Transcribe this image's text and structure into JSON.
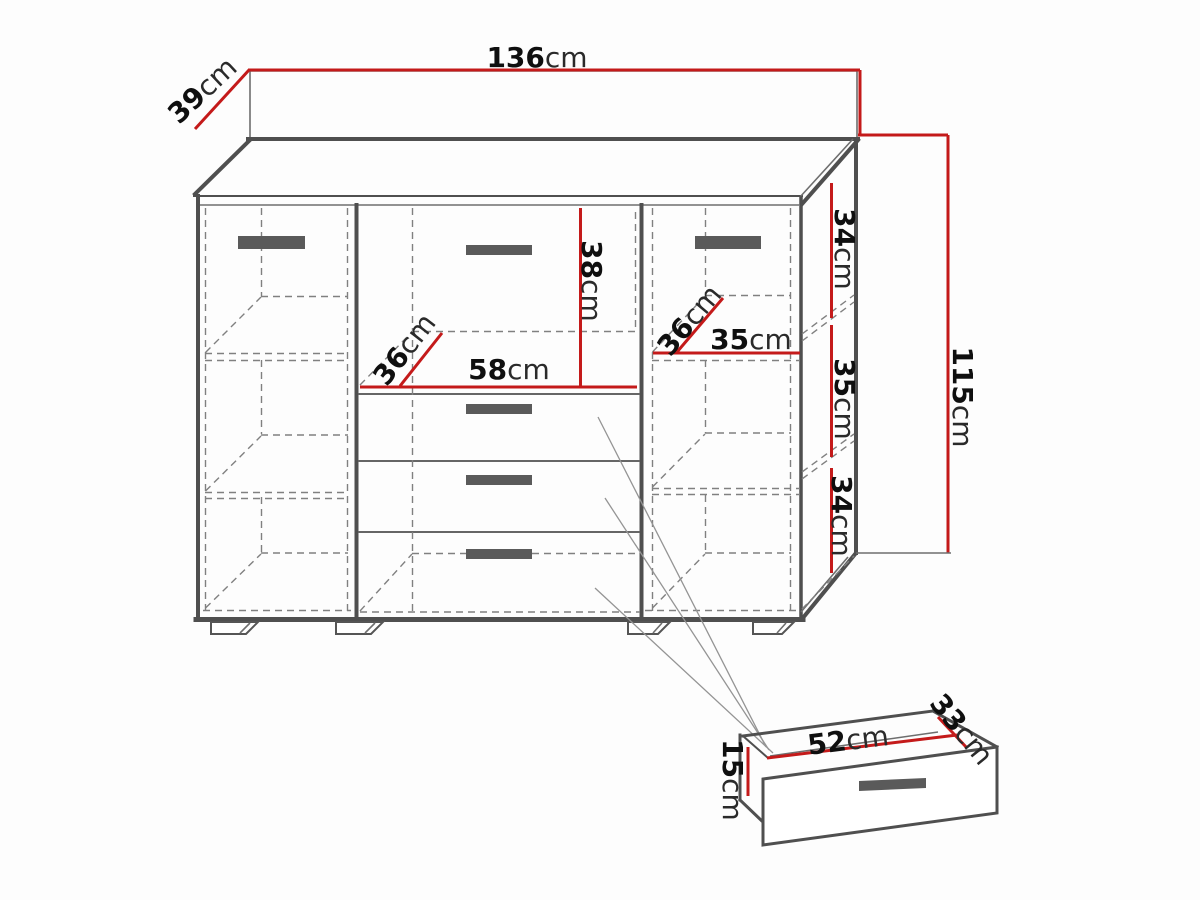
{
  "diagram": {
    "type": "furniture-technical-drawing",
    "subject": "sideboard-cabinet-with-doors-and-drawers",
    "views": [
      "cabinet-perspective",
      "single-drawer-detail"
    ]
  },
  "dimensions": {
    "width_total": {
      "value": "136",
      "unit": "cm"
    },
    "depth_top": {
      "value": "39",
      "unit": "cm"
    },
    "height_total": {
      "value": "115",
      "unit": "cm"
    },
    "drawer_top_height": {
      "value": "38",
      "unit": "cm"
    },
    "drawer_top_depth": {
      "value": "36",
      "unit": "cm"
    },
    "drawer_top_width": {
      "value": "58",
      "unit": "cm"
    },
    "shelf_right_depth": {
      "value": "36",
      "unit": "cm"
    },
    "shelf_right_width": {
      "value": "35",
      "unit": "cm"
    },
    "side_section_top": {
      "value": "34",
      "unit": "cm"
    },
    "side_section_mid": {
      "value": "35",
      "unit": "cm"
    },
    "side_section_bot": {
      "value": "34",
      "unit": "cm"
    },
    "drawer_detail_width": {
      "value": "52",
      "unit": "cm"
    },
    "drawer_detail_depth": {
      "value": "33",
      "unit": "cm"
    },
    "drawer_detail_height": {
      "value": "15",
      "unit": "cm"
    }
  },
  "colors": {
    "dimension_line": "#c41a1a",
    "outline": "#4f4f4f",
    "hidden_line": "#808080",
    "handle": "#5a5a5a",
    "background": "#fdfdfd"
  }
}
